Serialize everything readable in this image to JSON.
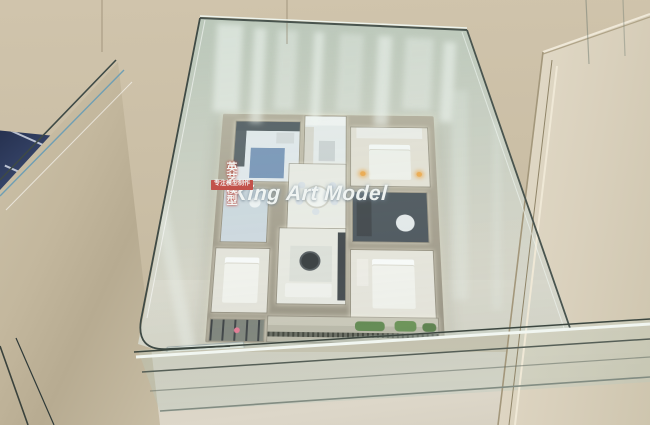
{
  "scene": {
    "type": "photograph",
    "subject": "apartment scale model displayed in a glass vitrine between marble pedestals"
  },
  "watermark": {
    "title": "King Art Model",
    "subtitle": "英艺模型",
    "badge1": "服务地产品牌",
    "badge2": "专注模型制作"
  },
  "plaques": {
    "info_line": "建筑面积: 89m²  比例: 1:25",
    "name_line1": "英艺模型 · KING ART MODEL",
    "name_line2": "建筑模型设计制作"
  },
  "icons": {
    "compass": "compass-rose-icon"
  },
  "colors": {
    "wall": "#cbbfa6",
    "marble_right": "#d9d0bc",
    "marble_left": "#c6bba2",
    "floor": "#d8d2c4",
    "glass_tint": "#bccfc3",
    "glass_edge": "#3c463f",
    "model_wall": "#a39a89",
    "led_glow": "#fff9e4",
    "navy_model": "#2a3550",
    "badge_red": "#c2312b",
    "compass_tan": "#c78f52"
  }
}
